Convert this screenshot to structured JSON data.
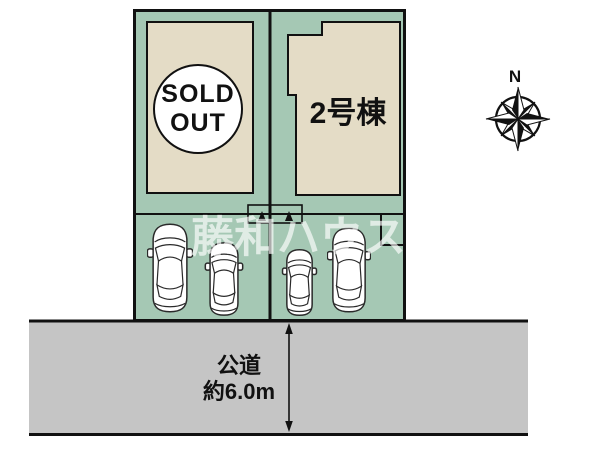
{
  "site_plan": {
    "watermark": "藤和ハウス",
    "lot_sold": {
      "badge_line1": "SOLD",
      "badge_line2": "OUT"
    },
    "lot_2": {
      "label": "2号棟"
    },
    "road": {
      "name": "公道",
      "width": "約6.0m"
    },
    "compass": {
      "north": "N"
    },
    "colors": {
      "lot_green": "#a5c8b4",
      "building_beige": "#e4dcc6",
      "road_gray": "#c5c5c5",
      "line_black": "#111111",
      "watermark_white": "rgba(255,255,255,0.65)"
    }
  }
}
